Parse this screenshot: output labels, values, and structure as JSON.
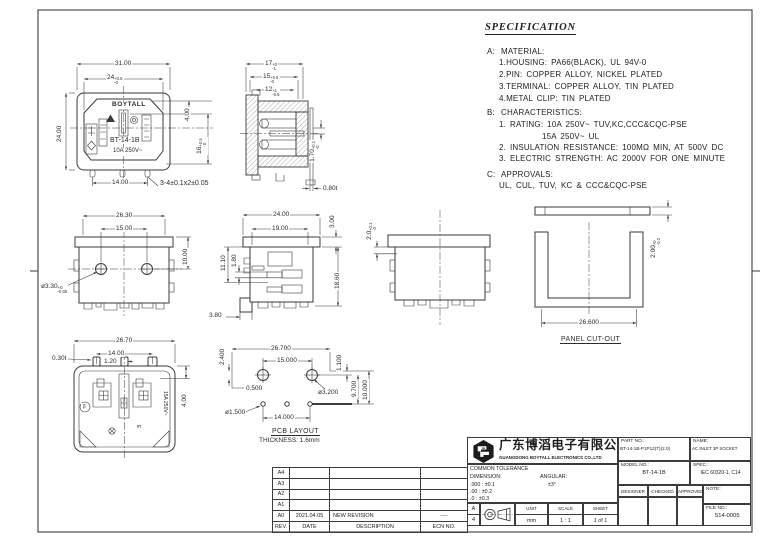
{
  "sheet": {
    "ink": "#3a3a3a",
    "border": "#3c3c3c",
    "bg": "#ffffff"
  },
  "spec": {
    "title": "SPECIFICATION",
    "sections": [
      {
        "label": "A:",
        "heading": "MATERIAL:",
        "items": [
          "1.HOUSING: PA66(BLACK), UL 94V-0",
          "2.PIN: COPPER ALLOY, NICKEL PLATED",
          "3.TERMINAL: COPPER ALLOY, TIN PLATED",
          "4.METAL CLIP: TIN PLATED"
        ]
      },
      {
        "label": "B:",
        "heading": "CHARACTERISTICS:",
        "items": [
          "1. RATING: 10A 250V~ TUV,KC,CCC&CQC-PSE",
          "15A 250V~ UL",
          "2. INSULATION RESISTANCE: 100MΩ MIN, AT 500V DC",
          "3. ELECTRIC STRENGTH: AC 2000V FOR ONE MINUTE"
        ]
      },
      {
        "label": "C:",
        "heading": "APPROVALS:",
        "items": [
          "UL, CUL, TUV, KC & CCC&CQC-PSE"
        ]
      }
    ]
  },
  "views": {
    "front": {
      "brand": "BOYTALL",
      "model": "BT-14-1B",
      "rating": "10A 250V~",
      "dims": {
        "width": "31.00",
        "opening": "24",
        "opening_tp": "+0.5",
        "opening_tm": "-0",
        "height": "24.00",
        "d4": "4.00",
        "d16": "16",
        "d16_tp": "+0.5",
        "d16_tm": "-0",
        "pitch": "14.00",
        "note": "3-4±0.1x2±0.05"
      }
    },
    "section": {
      "dims": {
        "d17": "17",
        "d17_tp": "+0",
        "d17_tm": "-1",
        "d15": "15",
        "d15_tp": "+0.5",
        "d15_tm": "-0",
        "d12": "12",
        "d12_tp": "+1",
        "d12_tm": "-0.5",
        "d170": "1.70",
        "d170_tp": "+0.1",
        "d170_tm": "-0",
        "d080": "0.80t"
      }
    },
    "back": {
      "dims": {
        "w": "26.30",
        "holes": "15.00",
        "h": "10.00",
        "dia": "ø3.30",
        "dia_tp": "+0",
        "dia_tm": "-0.05"
      }
    },
    "side": {
      "dims": {
        "w": "24.00",
        "w2": "19.00",
        "flange": "3.00",
        "d111": "11.10",
        "d18": "1.80",
        "h": "18.60",
        "foot": "3.80"
      }
    },
    "side2": {
      "dims": {
        "gap": "2.0",
        "gap_tp": "+0.1",
        "gap_tm": "-0"
      }
    },
    "panel": {
      "label": "PANEL CUT-OUT",
      "dims": {
        "w": "26.600",
        "t": "2.00",
        "t_tp": "+0",
        "t_tm": "-0.2"
      }
    },
    "bottom": {
      "ul_mark": "uL",
      "rating": "15A 250V~",
      "earth": "E",
      "dims": {
        "w": "26.70",
        "pitch": "14.00",
        "pin_w": "1.20",
        "pin_t": "0.30t",
        "d4": "4.00"
      }
    },
    "pcb": {
      "label": "PCB LAYOUT",
      "thickness": "THICKNESS: 1.6mm",
      "dims": {
        "w": "26.700",
        "holes": "15.000",
        "d24": "2.400",
        "d11": "1.100",
        "d05": "0.500",
        "dia32": "ø3.200",
        "dia15": "ø1.500",
        "pitch": "14.000",
        "d97": "9.700",
        "d10": "10.000"
      }
    }
  },
  "revision": {
    "headers": [
      "REV.",
      "DATE",
      "DESCRIPTION",
      "ECN NO."
    ],
    "rows": [
      [
        "A4",
        "",
        "",
        ""
      ],
      [
        "A3",
        "",
        "",
        ""
      ],
      [
        "A2",
        "",
        "",
        ""
      ],
      [
        "A1",
        "",
        "",
        ""
      ],
      [
        "A0",
        "2021.04.05",
        "NEW REVISION",
        "----"
      ]
    ]
  },
  "title_block": {
    "company_cn": "广东博滔电子有限公司",
    "company_en": "GUANGDONG BOYTALL ELECTRONICS CO.,LTD",
    "tolerance": {
      "title": "COMMON TOLERANCE",
      "dimension_label": "DIMENSION:",
      "angular_label": "ANGULAR:",
      "angular_value": "±3°",
      "rows": [
        ".000 : ±0.1",
        ".00 : ±0.2",
        ".0 : ±0.3"
      ]
    },
    "paper_a": "A",
    "paper_4": "4",
    "unit_label": "UNIT",
    "unit_value": "mm",
    "scale_label": "SCALE",
    "scale_value": "1 : 1",
    "sheet_label": "SHEET",
    "sheet_value": "1 of 1",
    "part_no_label": "PART NO.:",
    "part_no_value": "BT-14-1B-P1P12(T)(2.0)",
    "name_label": "NAME:",
    "name_value": "AC INLET 3P SOCKET",
    "model_no_label": "MODEL NO.:",
    "model_no_value": "BT-14-1B",
    "spec_label": "SPEC.:",
    "spec_value": "IEC 60320-1, C14",
    "sign_headers": [
      "DESIGNER",
      "CHECKED",
      "APPROVED"
    ],
    "note_label": "NOTE:",
    "file_no_label": "FILE NO.:",
    "file_no_value": "S14-0005"
  }
}
